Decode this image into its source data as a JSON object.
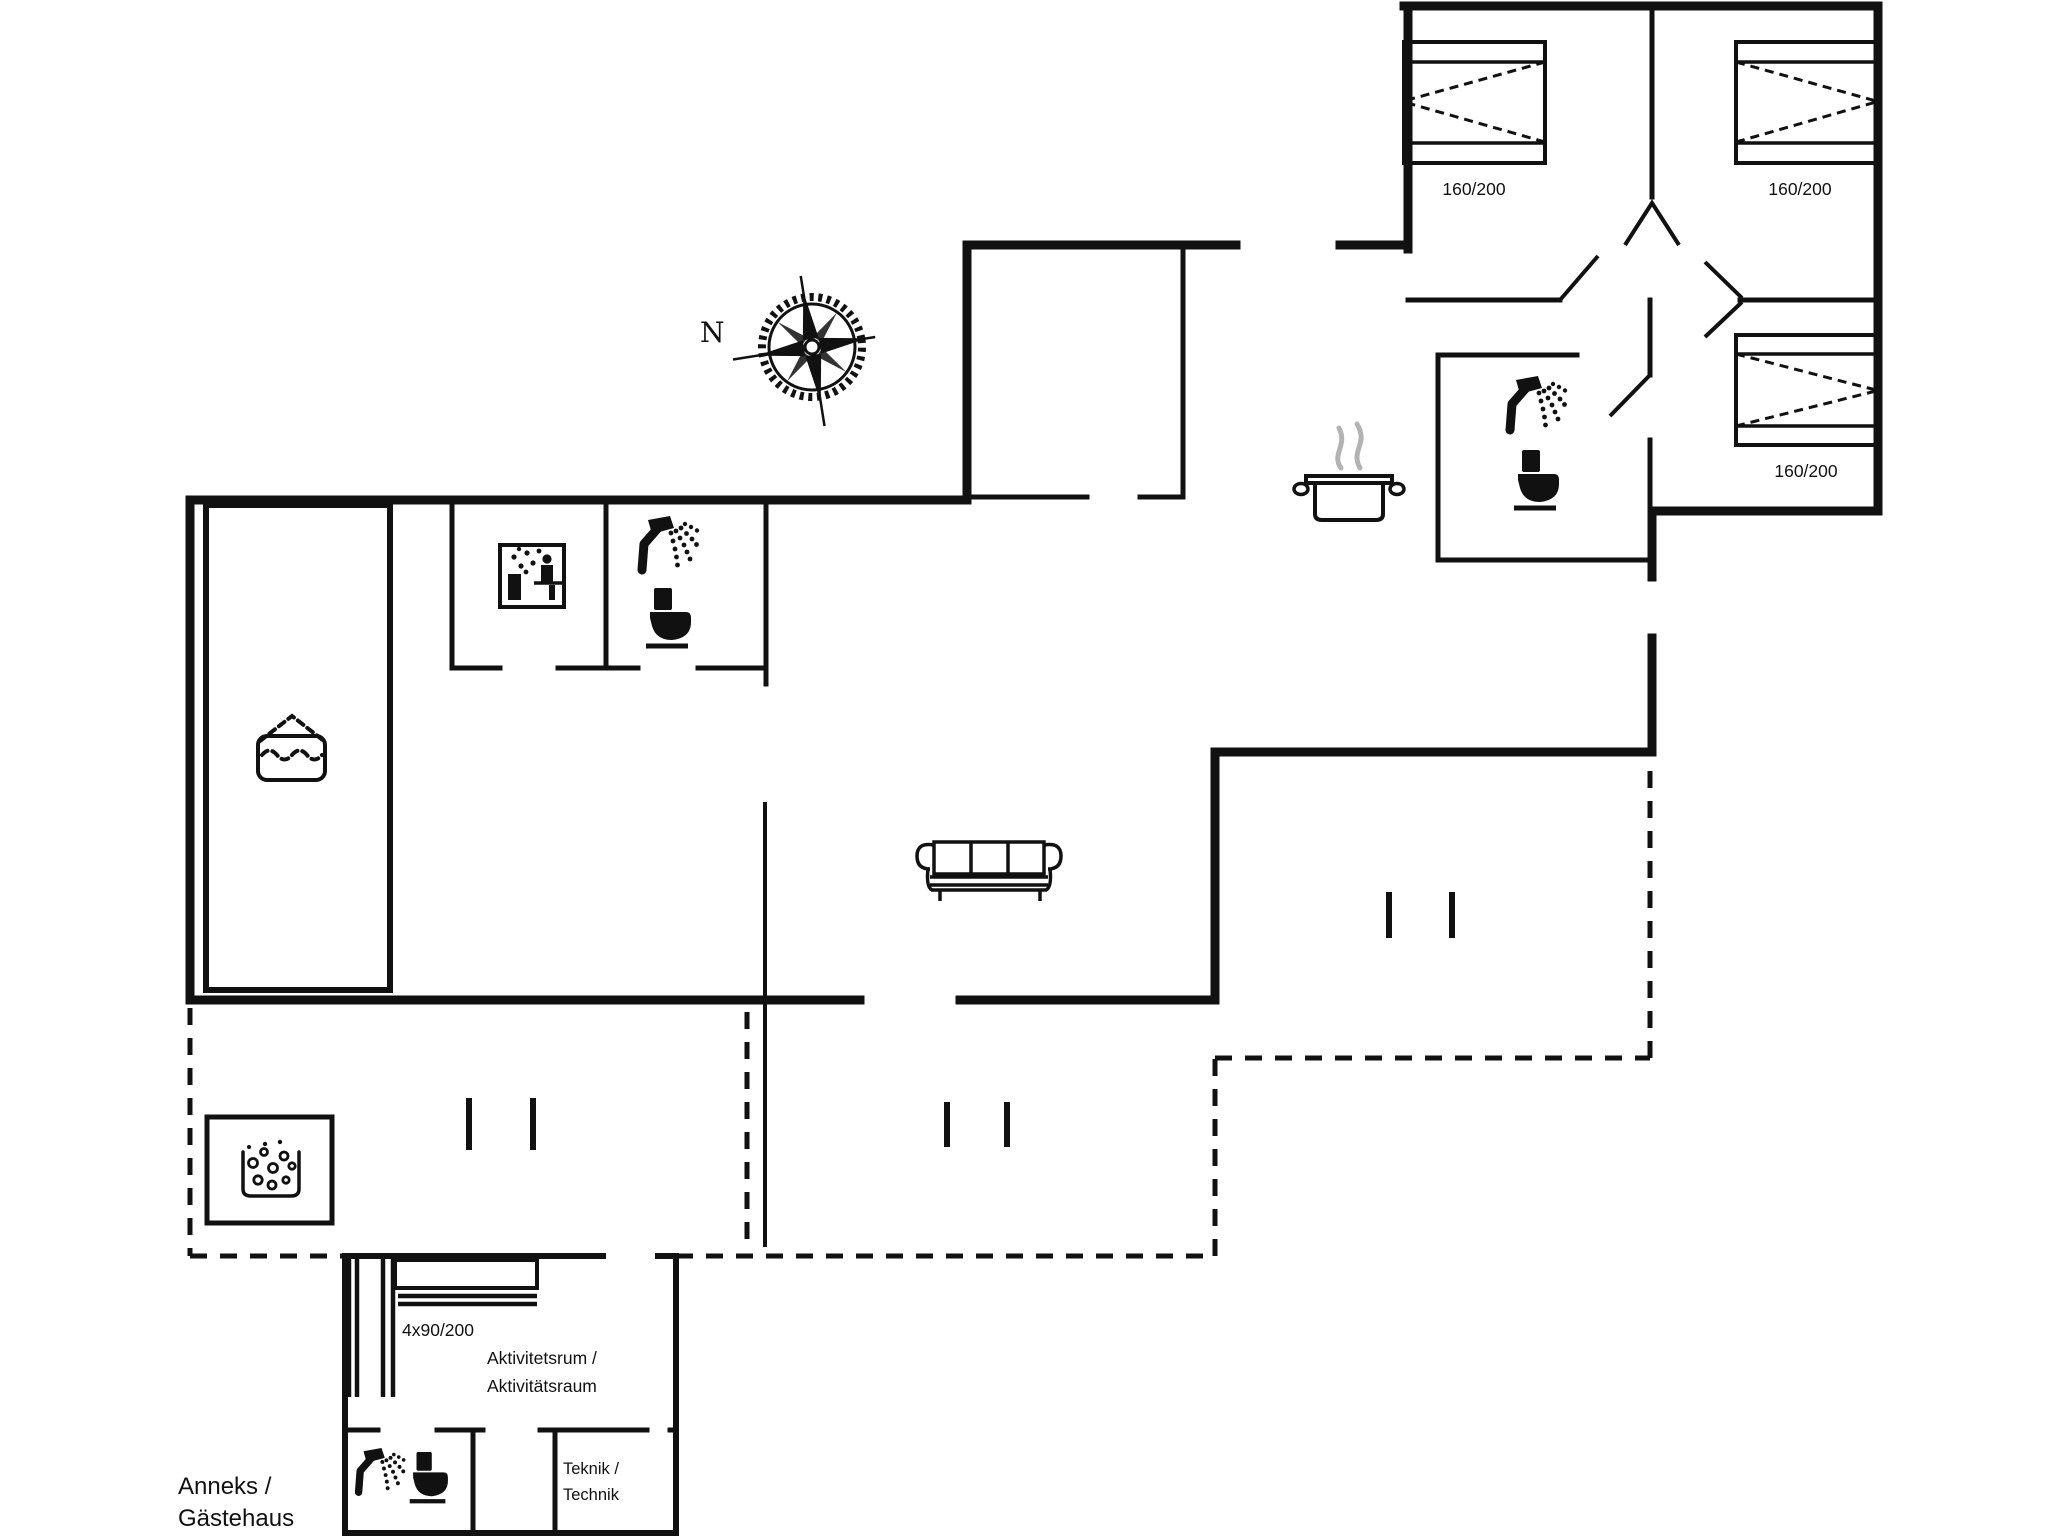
{
  "document": {
    "type": "floor-plan",
    "background_color": "#ffffff",
    "line_color": "#111111",
    "steam_color": "#b3b3b3"
  },
  "labels": {
    "compass_north": "N",
    "bedroom1_bed": "160/200",
    "bedroom2_bed": "160/200",
    "bedroom3_bed": "160/200",
    "bunk_beds": "4x90/200",
    "activity_room": [
      "Aktivitetsrum /",
      "Aktivitätsraum"
    ],
    "technic_room": [
      "Teknik /",
      "Technik"
    ],
    "annex": [
      "Anneks /",
      "Gästehaus"
    ]
  },
  "icons": [
    "compass-rose-icon",
    "double-bed-icon",
    "double-bed-icon",
    "double-bed-icon",
    "bunk-bed-icon",
    "shower-icon",
    "toilet-icon",
    "shower-icon",
    "toilet-icon",
    "shower-icon",
    "toilet-icon",
    "sauna-icon",
    "swimming-pool-icon",
    "cooking-pot-icon",
    "hot-tub-icon",
    "sofa-icon"
  ]
}
